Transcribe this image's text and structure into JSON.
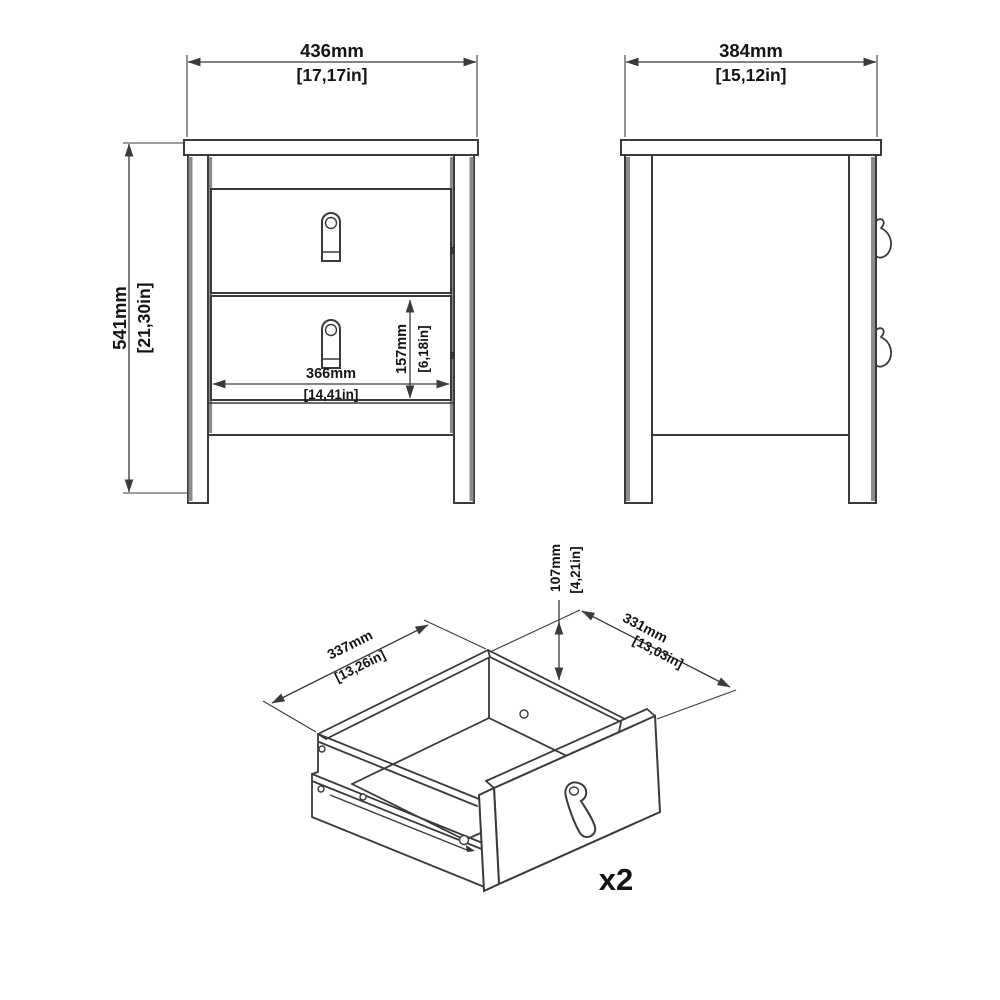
{
  "page": {
    "background": "#ffffff",
    "line_color": "#3a3a3a",
    "structure_gray": "#8b8b8b",
    "text_color": "#141414"
  },
  "views": {
    "front": {
      "dims": {
        "width_mm": "436mm",
        "width_in": "[17,17in]",
        "height_mm": "541mm",
        "height_in": "[21,30in]",
        "drawer_width_mm": "366mm",
        "drawer_width_in": "[14,41in]",
        "drawer_height_mm": "157mm",
        "drawer_height_in": "[6,18in]"
      }
    },
    "side": {
      "dims": {
        "depth_mm": "384mm",
        "depth_in": "[15,12in]"
      }
    },
    "drawer": {
      "dims": {
        "width_mm": "337mm",
        "width_in": "[13,26in]",
        "depth_mm": "331mm",
        "depth_in": "[13,03in]",
        "height_mm": "107mm",
        "height_in": "[4,21in]"
      },
      "quantity_label": "x2"
    }
  }
}
